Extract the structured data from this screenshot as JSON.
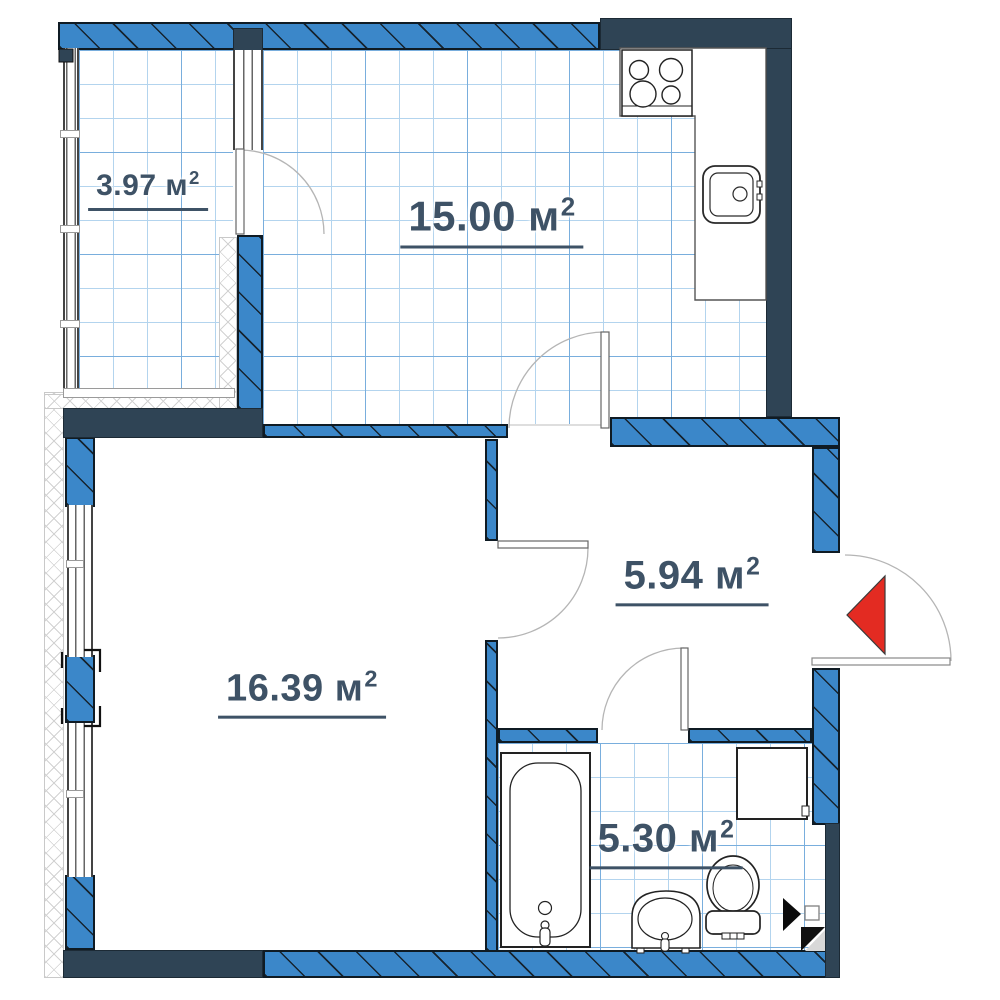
{
  "floorplan": {
    "type": "apartment-floor-plan",
    "unit_suffix": "м",
    "superscript": "2",
    "rooms": [
      {
        "key": "balcony",
        "area": "3.97"
      },
      {
        "key": "kitchen",
        "area": "15.00"
      },
      {
        "key": "hallway",
        "area": "5.94"
      },
      {
        "key": "living_room",
        "area": "16.39"
      },
      {
        "key": "bathroom",
        "area": "5.30"
      }
    ],
    "fixtures": [
      "stove",
      "kitchen-sink",
      "kitchen-counter",
      "bathtub",
      "wash-basin",
      "toilet",
      "washing-machine"
    ],
    "markers": [
      "entrance-arrow",
      "direction-marker",
      "shaft-symbol"
    ],
    "colors": {
      "wall_blue": "#3b87c9",
      "wall_navy": "#2f4455",
      "grid_line": "#b3d4ee",
      "grid_line_strong": "#79aedd",
      "label_text": "#3e5266",
      "entrance_arrow": "#e32b22",
      "hatch_line": "#16232e"
    }
  }
}
